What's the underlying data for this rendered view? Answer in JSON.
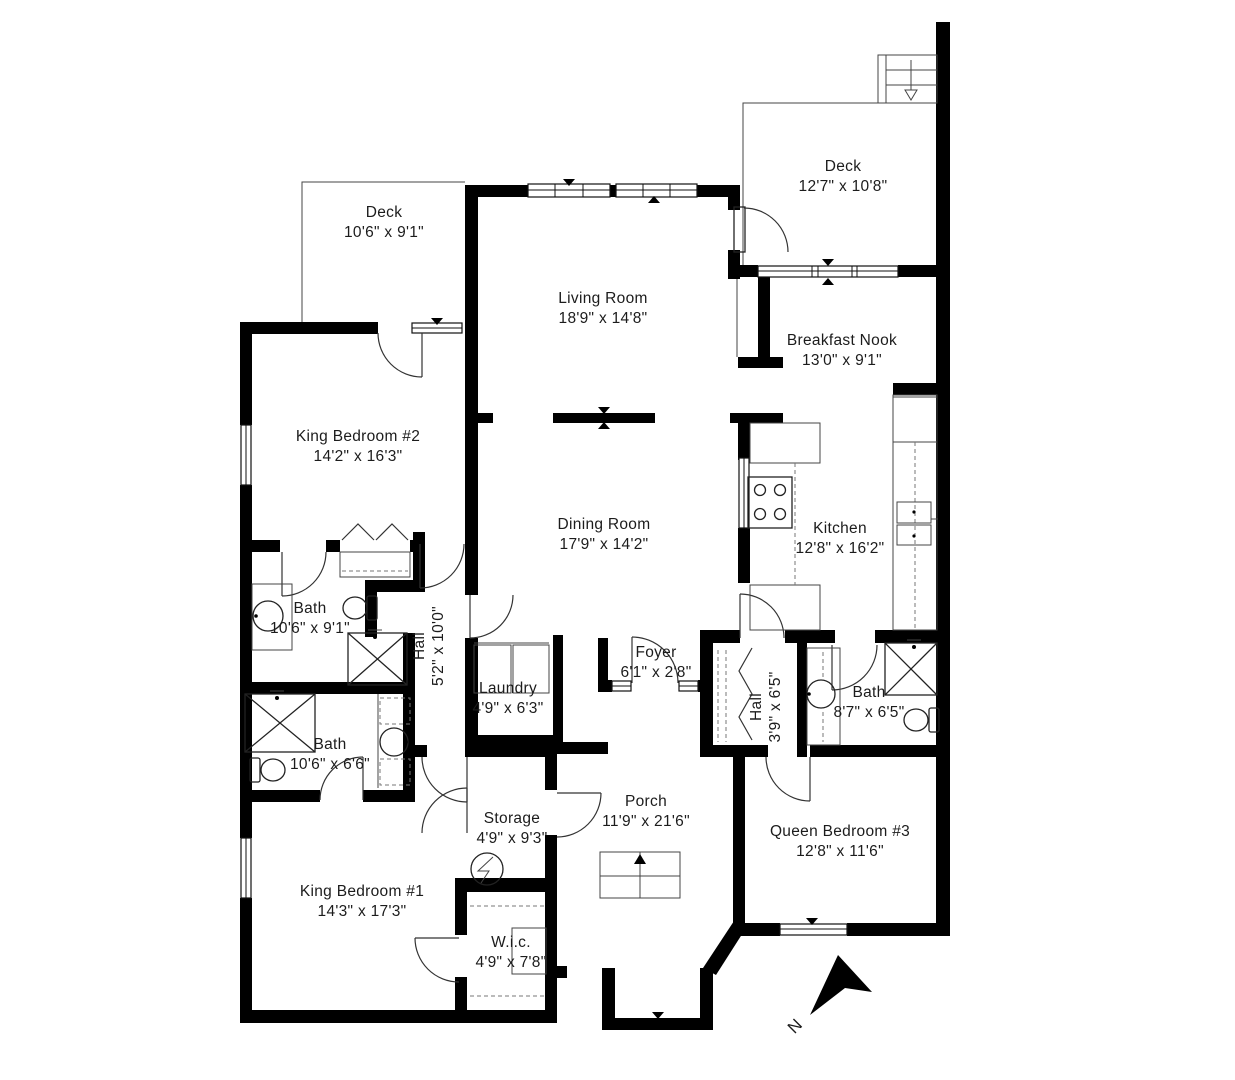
{
  "plan": {
    "background": "#ffffff",
    "wall_color": "#000000",
    "line_color": "#222222"
  },
  "rooms": [
    {
      "name": "Deck",
      "dims": "10'6\" x 9'1\""
    },
    {
      "name": "Living Room",
      "dims": "18'9\" x 14'8\""
    },
    {
      "name": "Deck",
      "dims": "12'7\" x 10'8\""
    },
    {
      "name": "Breakfast Nook",
      "dims": "13'0\" x 9'1\""
    },
    {
      "name": "King Bedroom #2",
      "dims": "14'2\" x 16'3\""
    },
    {
      "name": "Dining Room",
      "dims": "17'9\" x 14'2\""
    },
    {
      "name": "Kitchen",
      "dims": "12'8\" x 16'2\""
    },
    {
      "name": "Bath",
      "dims": "10'6\" x 9'1\""
    },
    {
      "name": "Hall",
      "dims": "5'2\" x 10'0\""
    },
    {
      "name": "Foyer",
      "dims": "6'1\" x 2'8\""
    },
    {
      "name": "Laundry",
      "dims": "4'9\" x 6'3\""
    },
    {
      "name": "Hall",
      "dims": "3'9\" x 6'5\""
    },
    {
      "name": "Bath",
      "dims": "8'7\" x 6'5\""
    },
    {
      "name": "Bath",
      "dims": "10'6\" x 6'6\""
    },
    {
      "name": "Storage",
      "dims": "4'9\" x 9'3\""
    },
    {
      "name": "Porch",
      "dims": "11'9\" x 21'6\""
    },
    {
      "name": "Queen Bedroom #3",
      "dims": "12'8\" x 11'6\""
    },
    {
      "name": "King Bedroom #1",
      "dims": "14'3\" x 17'3\""
    },
    {
      "name": "W.i.c.",
      "dims": "4'9\" x 7'8\""
    }
  ],
  "compass": {
    "label": "N"
  }
}
